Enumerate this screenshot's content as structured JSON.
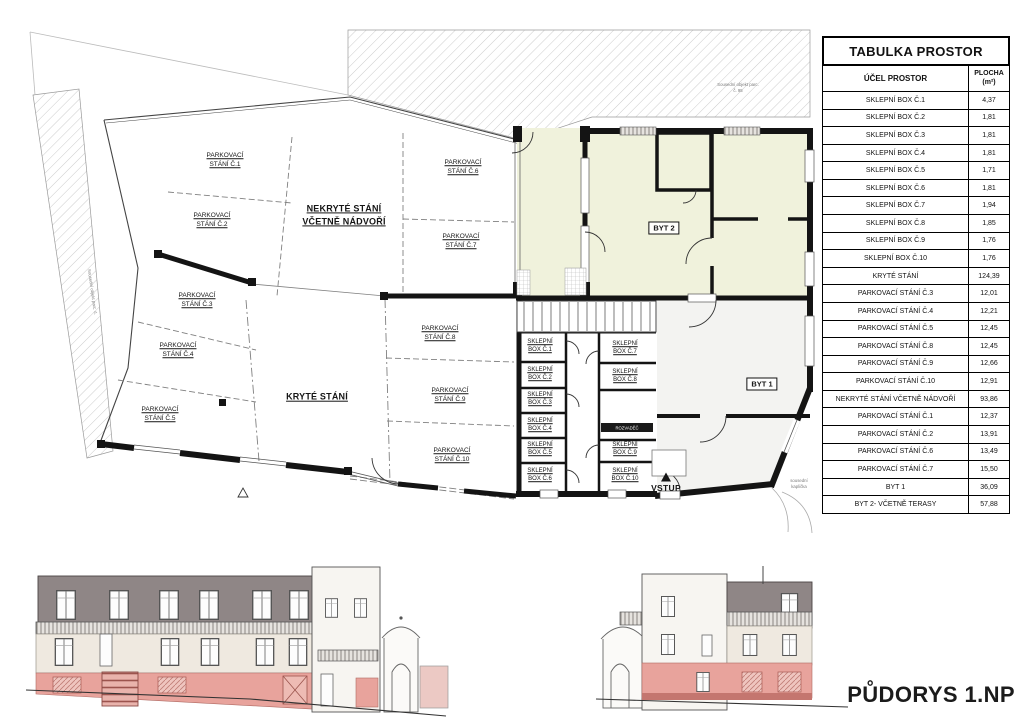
{
  "sheet": {
    "title": "PŮDORYS 1.NP"
  },
  "table": {
    "title": "TABULKA PROSTOR",
    "columns": {
      "purpose": "ÚČEL PROSTOR",
      "area": "PLOCHA",
      "area_unit": "(m²)"
    },
    "rows": [
      {
        "label": "SKLEPNÍ BOX Č.1",
        "area": "4,37"
      },
      {
        "label": "SKLEPNÍ BOX Č.2",
        "area": "1,81"
      },
      {
        "label": "SKLEPNÍ BOX Č.3",
        "area": "1,81"
      },
      {
        "label": "SKLEPNÍ BOX Č.4",
        "area": "1,81"
      },
      {
        "label": "SKLEPNÍ BOX Č.5",
        "area": "1,71"
      },
      {
        "label": "SKLEPNÍ BOX Č.6",
        "area": "1,81"
      },
      {
        "label": "SKLEPNÍ BOX Č.7",
        "area": "1,94"
      },
      {
        "label": "SKLEPNÍ BOX Č.8",
        "area": "1,85"
      },
      {
        "label": "SKLEPNÍ BOX Č.9",
        "area": "1,76"
      },
      {
        "label": "SKLEPNÍ BOX Č.10",
        "area": "1,76"
      },
      {
        "label": "KRYTÉ STÁNÍ",
        "area": "124,39"
      },
      {
        "label": "PARKOVACÍ STÁNÍ Č.3",
        "area": "12,01"
      },
      {
        "label": "PARKOVACÍ STÁNÍ Č.4",
        "area": "12,21"
      },
      {
        "label": "PARKOVACÍ STÁNÍ Č.5",
        "area": "12,45"
      },
      {
        "label": "PARKOVACÍ STÁNÍ Č.8",
        "area": "12,45"
      },
      {
        "label": "PARKOVACÍ STÁNÍ Č.9",
        "area": "12,66"
      },
      {
        "label": "PARKOVACÍ STÁNÍ Č.10",
        "area": "12,91"
      },
      {
        "label": "NEKRYTÉ STÁNÍ VČETNĚ NÁDVOŘÍ",
        "area": "93,86"
      },
      {
        "label": "PARKOVACÍ STÁNÍ Č.1",
        "area": "12,37"
      },
      {
        "label": "PARKOVACÍ STÁNÍ Č.2",
        "area": "13,91"
      },
      {
        "label": "PARKOVACÍ STÁNÍ Č.6",
        "area": "13,49"
      },
      {
        "label": "PARKOVACÍ STÁNÍ Č.7",
        "area": "15,50"
      },
      {
        "label": "BYT 1",
        "area": "36,09"
      },
      {
        "label": "BYT 2- VČETNĚ TERASY",
        "area": "57,88"
      }
    ]
  },
  "plan": {
    "area_labels": {
      "nekryte": "NEKRYTÉ STÁNÍ\nVČETNĚ NÁDVOŘÍ",
      "kryte": "KRYTÉ STÁNÍ",
      "byt1": "BYT 1",
      "byt2": "BYT 2",
      "vstup": "VSTUP",
      "rozvadec": "ROZVADĚČ"
    },
    "parking": [
      "PARKOVACÍ STÁNÍ Č.1",
      "PARKOVACÍ STÁNÍ Č.2",
      "PARKOVACÍ STÁNÍ Č.3",
      "PARKOVACÍ STÁNÍ Č.4",
      "PARKOVACÍ STÁNÍ Č.5",
      "PARKOVACÍ STÁNÍ Č.6",
      "PARKOVACÍ STÁNÍ Č.7",
      "PARKOVACÍ STÁNÍ Č.8",
      "PARKOVACÍ STÁNÍ Č.9",
      "PARKOVACÍ STÁNÍ Č.10"
    ],
    "sklepni": [
      "SKLEPNÍ BOX Č.1",
      "SKLEPNÍ BOX Č.2",
      "SKLEPNÍ BOX Č.3",
      "SKLEPNÍ BOX Č.4",
      "SKLEPNÍ BOX Č.5",
      "SKLEPNÍ BOX Č.6",
      "SKLEPNÍ BOX Č.7",
      "SKLEPNÍ BOX Č.8",
      "SKLEPNÍ BOX Č.9",
      "SKLEPNÍ BOX Č.10"
    ],
    "notes": {
      "neighbor_top": "Sousední objekt parc.\nč. 95",
      "neighbor_left": "Sousední objekt parc. č.",
      "kaplicka": "sousední\nkaplička"
    }
  },
  "colors": {
    "apartment_fill": "#f0f2dc",
    "highlight_pink": "#e8a39c",
    "facade_grey": "#8f8686",
    "facade_cream": "#efe9e0"
  }
}
